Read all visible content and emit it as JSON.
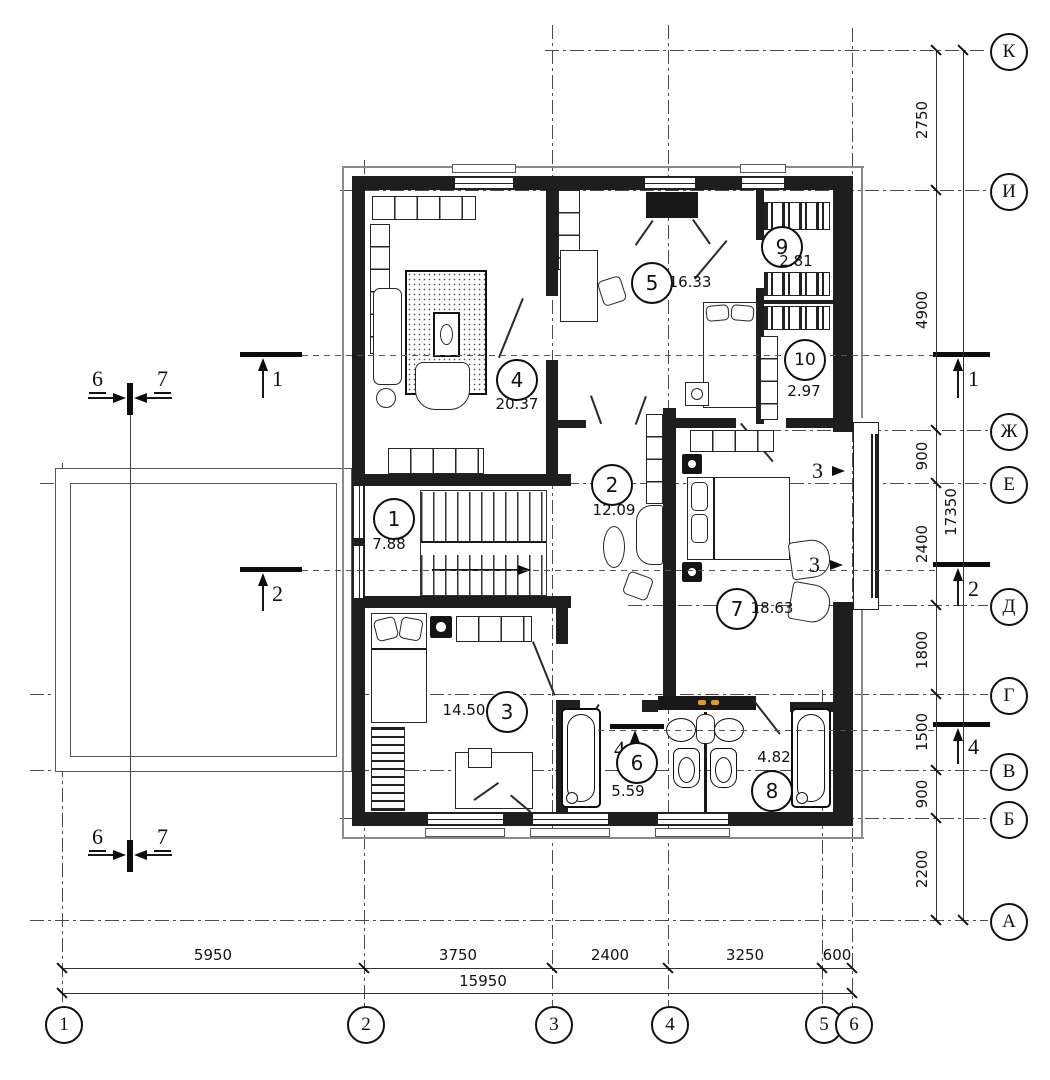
{
  "axes_horizontal": [
    {
      "label": "К"
    },
    {
      "label": "И"
    },
    {
      "label": "Ж"
    },
    {
      "label": "Е"
    },
    {
      "label": "Д"
    },
    {
      "label": "Г"
    },
    {
      "label": "В"
    },
    {
      "label": "Б"
    },
    {
      "label": "А"
    }
  ],
  "axes_vertical": [
    {
      "label": "1"
    },
    {
      "label": "2"
    },
    {
      "label": "3"
    },
    {
      "label": "4"
    },
    {
      "label": "5"
    },
    {
      "label": "6"
    }
  ],
  "dims_right": [
    "2750",
    "4900",
    "900",
    "2400",
    "1800",
    "1500",
    "900",
    "2200"
  ],
  "dims_right_total": "17350",
  "dims_bottom": [
    "5950",
    "3750",
    "2400",
    "3250",
    "600"
  ],
  "dims_bottom_total": "15950",
  "rooms": [
    {
      "number": "1",
      "area": "7.88"
    },
    {
      "number": "2",
      "area": "12.09"
    },
    {
      "number": "3",
      "area": "14.50"
    },
    {
      "number": "4",
      "area": "20.37"
    },
    {
      "number": "5",
      "area": "16.33"
    },
    {
      "number": "6",
      "area": "5.59"
    },
    {
      "number": "7",
      "area": "18.63"
    },
    {
      "number": "8",
      "area": "4.82"
    },
    {
      "number": "9",
      "area": "2.81"
    },
    {
      "number": "10",
      "area": "2.97"
    }
  ],
  "sections": {
    "s1": "1",
    "s2": "2",
    "s3": "3",
    "s4": "4",
    "s6": "6",
    "s7": "7"
  }
}
